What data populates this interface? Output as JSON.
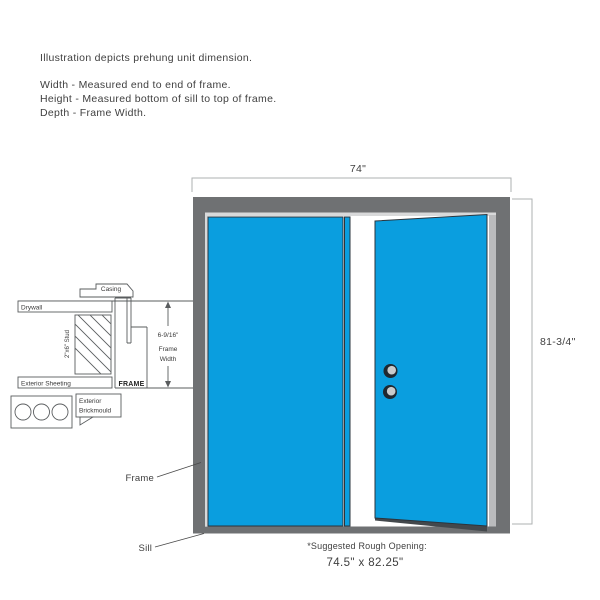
{
  "description": {
    "intro": "Illustration depicts prehung unit dimension.",
    "width_def": "Width - Measured end to end of frame.",
    "height_def": "Height - Measured bottom of sill to top of frame.",
    "depth_def": "Depth - Frame Width."
  },
  "dimensions": {
    "width": "74\"",
    "height": "81-3/4\"",
    "frame_width_value": "6-9/16\"",
    "frame_width_label_line1": "Frame",
    "frame_width_label_line2": "Width"
  },
  "section": {
    "casing_label": "Casing",
    "drywall_label": "Drywall",
    "stud_label": "2\"x6\" Stud",
    "sheeting_label": "Exterior Sheeting",
    "frame_label": "FRAME",
    "brickmould_label_line1": "Exterior",
    "brickmould_label_line2": "Brickmould"
  },
  "callouts": {
    "frame_label": "Frame",
    "sill_label": "Sill"
  },
  "rough_opening": {
    "note": "*Suggested Rough Opening:",
    "value": "74.5\" x 82.25\""
  },
  "colors": {
    "door_blue": "#0A9EDF",
    "frame_gray": "#6F7173",
    "jamb_gray": "#BABBBD",
    "sill_gray": "#6F7173",
    "door_edge_dark": "#43484C",
    "highlight_gray": "#D8D9DA",
    "knob_dark": "#1F2830",
    "knob_light": "#C9CBCC"
  }
}
